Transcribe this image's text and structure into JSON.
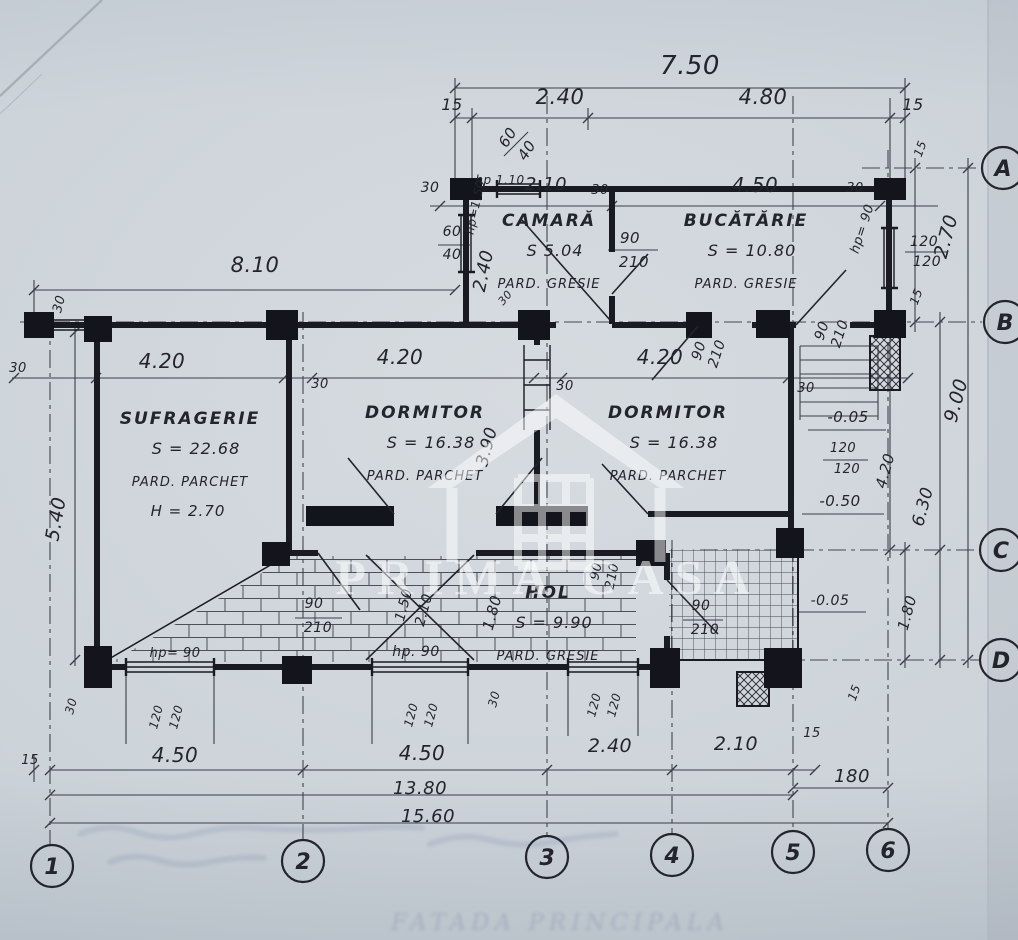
{
  "watermark": {
    "text": "PRIMA CASA"
  },
  "ghost_text": {
    "text": "FATADA PRINCIPALA"
  },
  "grid_axes": {
    "columns": [
      {
        "label": "1",
        "x": 52,
        "y": 866
      },
      {
        "label": "2",
        "x": 303,
        "y": 861
      },
      {
        "label": "3",
        "x": 547,
        "y": 857
      },
      {
        "label": "4",
        "x": 672,
        "y": 855
      },
      {
        "label": "5",
        "x": 793,
        "y": 852
      },
      {
        "label": "6",
        "x": 888,
        "y": 850
      }
    ],
    "rows": [
      {
        "label": "A",
        "x": 1003,
        "y": 168
      },
      {
        "label": "B",
        "x": 1005,
        "y": 322
      },
      {
        "label": "C",
        "x": 1001,
        "y": 550
      },
      {
        "label": "D",
        "x": 1001,
        "y": 660
      }
    ]
  },
  "rooms": [
    {
      "name": "CAMARĂ",
      "area": "S 5.04",
      "floor": "PARD. GRESIE",
      "height": "",
      "x": 549,
      "y": 226
    },
    {
      "name": "BUCĂTĂRIE",
      "area": "S = 10.80",
      "floor": "PARD.   GRESIE",
      "height": "",
      "x": 746,
      "y": 226
    },
    {
      "name": "SUFRAGERIE",
      "area": "S = 22.68",
      "floor": "PARD. PARCHET",
      "height": "H = 2.70",
      "x": 190,
      "y": 424
    },
    {
      "name": "DORMITOR",
      "area": "S = 16.38",
      "floor": "PARD. PARCHET",
      "height": "",
      "x": 425,
      "y": 418
    },
    {
      "name": "DORMITOR",
      "area": "S = 16.38",
      "floor": "PARD. PARCHET",
      "height": "",
      "x": 668,
      "y": 418
    },
    {
      "name": "HOL",
      "area": "S = 9.90",
      "floor": "PARD. GRESIE",
      "height": "",
      "x": 548,
      "y": 598
    }
  ],
  "labels": [
    {
      "t": "7.50",
      "x": 690,
      "y": 74,
      "r": 0,
      "s": 26
    },
    {
      "t": "15",
      "x": 452,
      "y": 110,
      "r": 0,
      "s": 16
    },
    {
      "t": "2.40",
      "x": 560,
      "y": 104,
      "r": 0,
      "s": 21
    },
    {
      "t": "4.80",
      "x": 763,
      "y": 104,
      "r": 0,
      "s": 21
    },
    {
      "t": "15",
      "x": 913,
      "y": 110,
      "r": 0,
      "s": 16
    },
    {
      "t": "60",
      "x": 512,
      "y": 140,
      "r": -58,
      "s": 15
    },
    {
      "t": "40",
      "x": 531,
      "y": 153,
      "r": -58,
      "s": 15
    },
    {
      "t": "30",
      "x": 430,
      "y": 192,
      "r": 0,
      "s": 14
    },
    {
      "t": "hp 1.10",
      "x": 500,
      "y": 184,
      "r": 0,
      "s": 12
    },
    {
      "t": "2.10",
      "x": 546,
      "y": 190,
      "r": 0,
      "s": 18
    },
    {
      "t": "30",
      "x": 600,
      "y": 194,
      "r": 0,
      "s": 13
    },
    {
      "t": "4.50",
      "x": 755,
      "y": 192,
      "r": 0,
      "s": 20
    },
    {
      "t": "30",
      "x": 855,
      "y": 192,
      "r": 0,
      "s": 13
    },
    {
      "t": "hp= 90",
      "x": 866,
      "y": 230,
      "r": -72,
      "s": 13
    },
    {
      "t": "120",
      "x": 924,
      "y": 246,
      "r": 0,
      "s": 14
    },
    {
      "t": "120",
      "x": 927,
      "y": 266,
      "r": 0,
      "s": 14
    },
    {
      "t": "2.70",
      "x": 952,
      "y": 238,
      "r": -75,
      "s": 19
    },
    {
      "t": "15",
      "x": 924,
      "y": 150,
      "r": -70,
      "s": 12
    },
    {
      "t": "15",
      "x": 920,
      "y": 298,
      "r": -70,
      "s": 12
    },
    {
      "t": "hp=1.50",
      "x": 479,
      "y": 208,
      "r": -78,
      "s": 12
    },
    {
      "t": "2.40",
      "x": 489,
      "y": 272,
      "r": -78,
      "s": 18
    },
    {
      "t": "60",
      "x": 452,
      "y": 236,
      "r": 0,
      "s": 14
    },
    {
      "t": "40",
      "x": 452,
      "y": 259,
      "r": 0,
      "s": 14
    },
    {
      "t": "90",
      "x": 630,
      "y": 243,
      "r": 0,
      "s": 15
    },
    {
      "t": "210",
      "x": 634,
      "y": 267,
      "r": 0,
      "s": 15
    },
    {
      "t": "30",
      "x": 508,
      "y": 300,
      "r": -50,
      "s": 11
    },
    {
      "t": "90",
      "x": 703,
      "y": 352,
      "r": -72,
      "s": 14
    },
    {
      "t": "210",
      "x": 721,
      "y": 355,
      "r": -72,
      "s": 14
    },
    {
      "t": "90",
      "x": 826,
      "y": 332,
      "r": -72,
      "s": 14
    },
    {
      "t": "210",
      "x": 844,
      "y": 335,
      "r": -72,
      "s": 14
    },
    {
      "t": "30",
      "x": 806,
      "y": 392,
      "r": 0,
      "s": 13
    },
    {
      "t": "8.10",
      "x": 255,
      "y": 272,
      "r": 0,
      "s": 21
    },
    {
      "t": "30",
      "x": 63,
      "y": 305,
      "r": -75,
      "s": 13
    },
    {
      "t": "30",
      "x": 18,
      "y": 372,
      "r": 0,
      "s": 13
    },
    {
      "t": "4.20",
      "x": 162,
      "y": 368,
      "r": 0,
      "s": 20
    },
    {
      "t": "30",
      "x": 320,
      "y": 388,
      "r": 0,
      "s": 13
    },
    {
      "t": "4.20",
      "x": 400,
      "y": 364,
      "r": 0,
      "s": 20
    },
    {
      "t": "30",
      "x": 565,
      "y": 390,
      "r": 0,
      "s": 13
    },
    {
      "t": "4.20",
      "x": 660,
      "y": 364,
      "r": 0,
      "s": 20
    },
    {
      "t": "5.40",
      "x": 62,
      "y": 520,
      "r": -80,
      "s": 19
    },
    {
      "t": "3.90",
      "x": 492,
      "y": 448,
      "r": -75,
      "s": 17
    },
    {
      "t": "90",
      "x": 600,
      "y": 572,
      "r": -78,
      "s": 13
    },
    {
      "t": "210",
      "x": 616,
      "y": 577,
      "r": -78,
      "s": 13
    },
    {
      "t": "1.50",
      "x": 408,
      "y": 606,
      "r": -75,
      "s": 14
    },
    {
      "t": "2.10",
      "x": 428,
      "y": 611,
      "r": -75,
      "s": 14
    },
    {
      "t": "1.80",
      "x": 497,
      "y": 614,
      "r": -75,
      "s": 15
    },
    {
      "t": "90",
      "x": 701,
      "y": 610,
      "r": 0,
      "s": 14
    },
    {
      "t": "210",
      "x": 705,
      "y": 634,
      "r": 0,
      "s": 14
    },
    {
      "t": "90",
      "x": 314,
      "y": 608,
      "r": 0,
      "s": 14
    },
    {
      "t": "210",
      "x": 318,
      "y": 632,
      "r": 0,
      "s": 14
    },
    {
      "t": "hp= 90",
      "x": 175,
      "y": 657,
      "r": 0,
      "s": 13
    },
    {
      "t": "hp. 90",
      "x": 416,
      "y": 656,
      "r": 0,
      "s": 14
    },
    {
      "t": "-0.05",
      "x": 848,
      "y": 422,
      "r": 0,
      "s": 15
    },
    {
      "t": "120",
      "x": 843,
      "y": 452,
      "r": 0,
      "s": 13
    },
    {
      "t": "120",
      "x": 847,
      "y": 473,
      "r": 0,
      "s": 13
    },
    {
      "t": "-0.50",
      "x": 840,
      "y": 506,
      "r": 0,
      "s": 15
    },
    {
      "t": "-0.05",
      "x": 830,
      "y": 605,
      "r": 0,
      "s": 14
    },
    {
      "t": "4.20",
      "x": 890,
      "y": 472,
      "r": -75,
      "s": 15
    },
    {
      "t": "6.30",
      "x": 928,
      "y": 508,
      "r": -75,
      "s": 17
    },
    {
      "t": "9.00",
      "x": 962,
      "y": 402,
      "r": -75,
      "s": 19
    },
    {
      "t": "1.80",
      "x": 912,
      "y": 614,
      "r": -75,
      "s": 15
    },
    {
      "t": "15",
      "x": 858,
      "y": 694,
      "r": -70,
      "s": 12
    },
    {
      "t": "30",
      "x": 75,
      "y": 707,
      "r": -75,
      "s": 12
    },
    {
      "t": "120",
      "x": 160,
      "y": 718,
      "r": -75,
      "s": 12
    },
    {
      "t": "120",
      "x": 180,
      "y": 718,
      "r": -75,
      "s": 12
    },
    {
      "t": "120",
      "x": 415,
      "y": 716,
      "r": -75,
      "s": 12
    },
    {
      "t": "120",
      "x": 435,
      "y": 716,
      "r": -75,
      "s": 12
    },
    {
      "t": "30",
      "x": 498,
      "y": 700,
      "r": -75,
      "s": 12
    },
    {
      "t": "120",
      "x": 598,
      "y": 706,
      "r": -75,
      "s": 12
    },
    {
      "t": "120",
      "x": 618,
      "y": 706,
      "r": -75,
      "s": 12
    },
    {
      "t": "15",
      "x": 30,
      "y": 764,
      "r": 0,
      "s": 13
    },
    {
      "t": "4.50",
      "x": 175,
      "y": 762,
      "r": 0,
      "s": 20
    },
    {
      "t": "4.50",
      "x": 422,
      "y": 760,
      "r": 0,
      "s": 20
    },
    {
      "t": "2.40",
      "x": 610,
      "y": 752,
      "r": 0,
      "s": 19
    },
    {
      "t": "2.10",
      "x": 736,
      "y": 750,
      "r": 0,
      "s": 19
    },
    {
      "t": "15",
      "x": 812,
      "y": 737,
      "r": 0,
      "s": 13
    },
    {
      "t": "180",
      "x": 852,
      "y": 782,
      "r": 0,
      "s": 18
    },
    {
      "t": "13.80",
      "x": 420,
      "y": 794,
      "r": 0,
      "s": 18
    },
    {
      "t": "15.60",
      "x": 428,
      "y": 822,
      "r": 0,
      "s": 18
    }
  ]
}
